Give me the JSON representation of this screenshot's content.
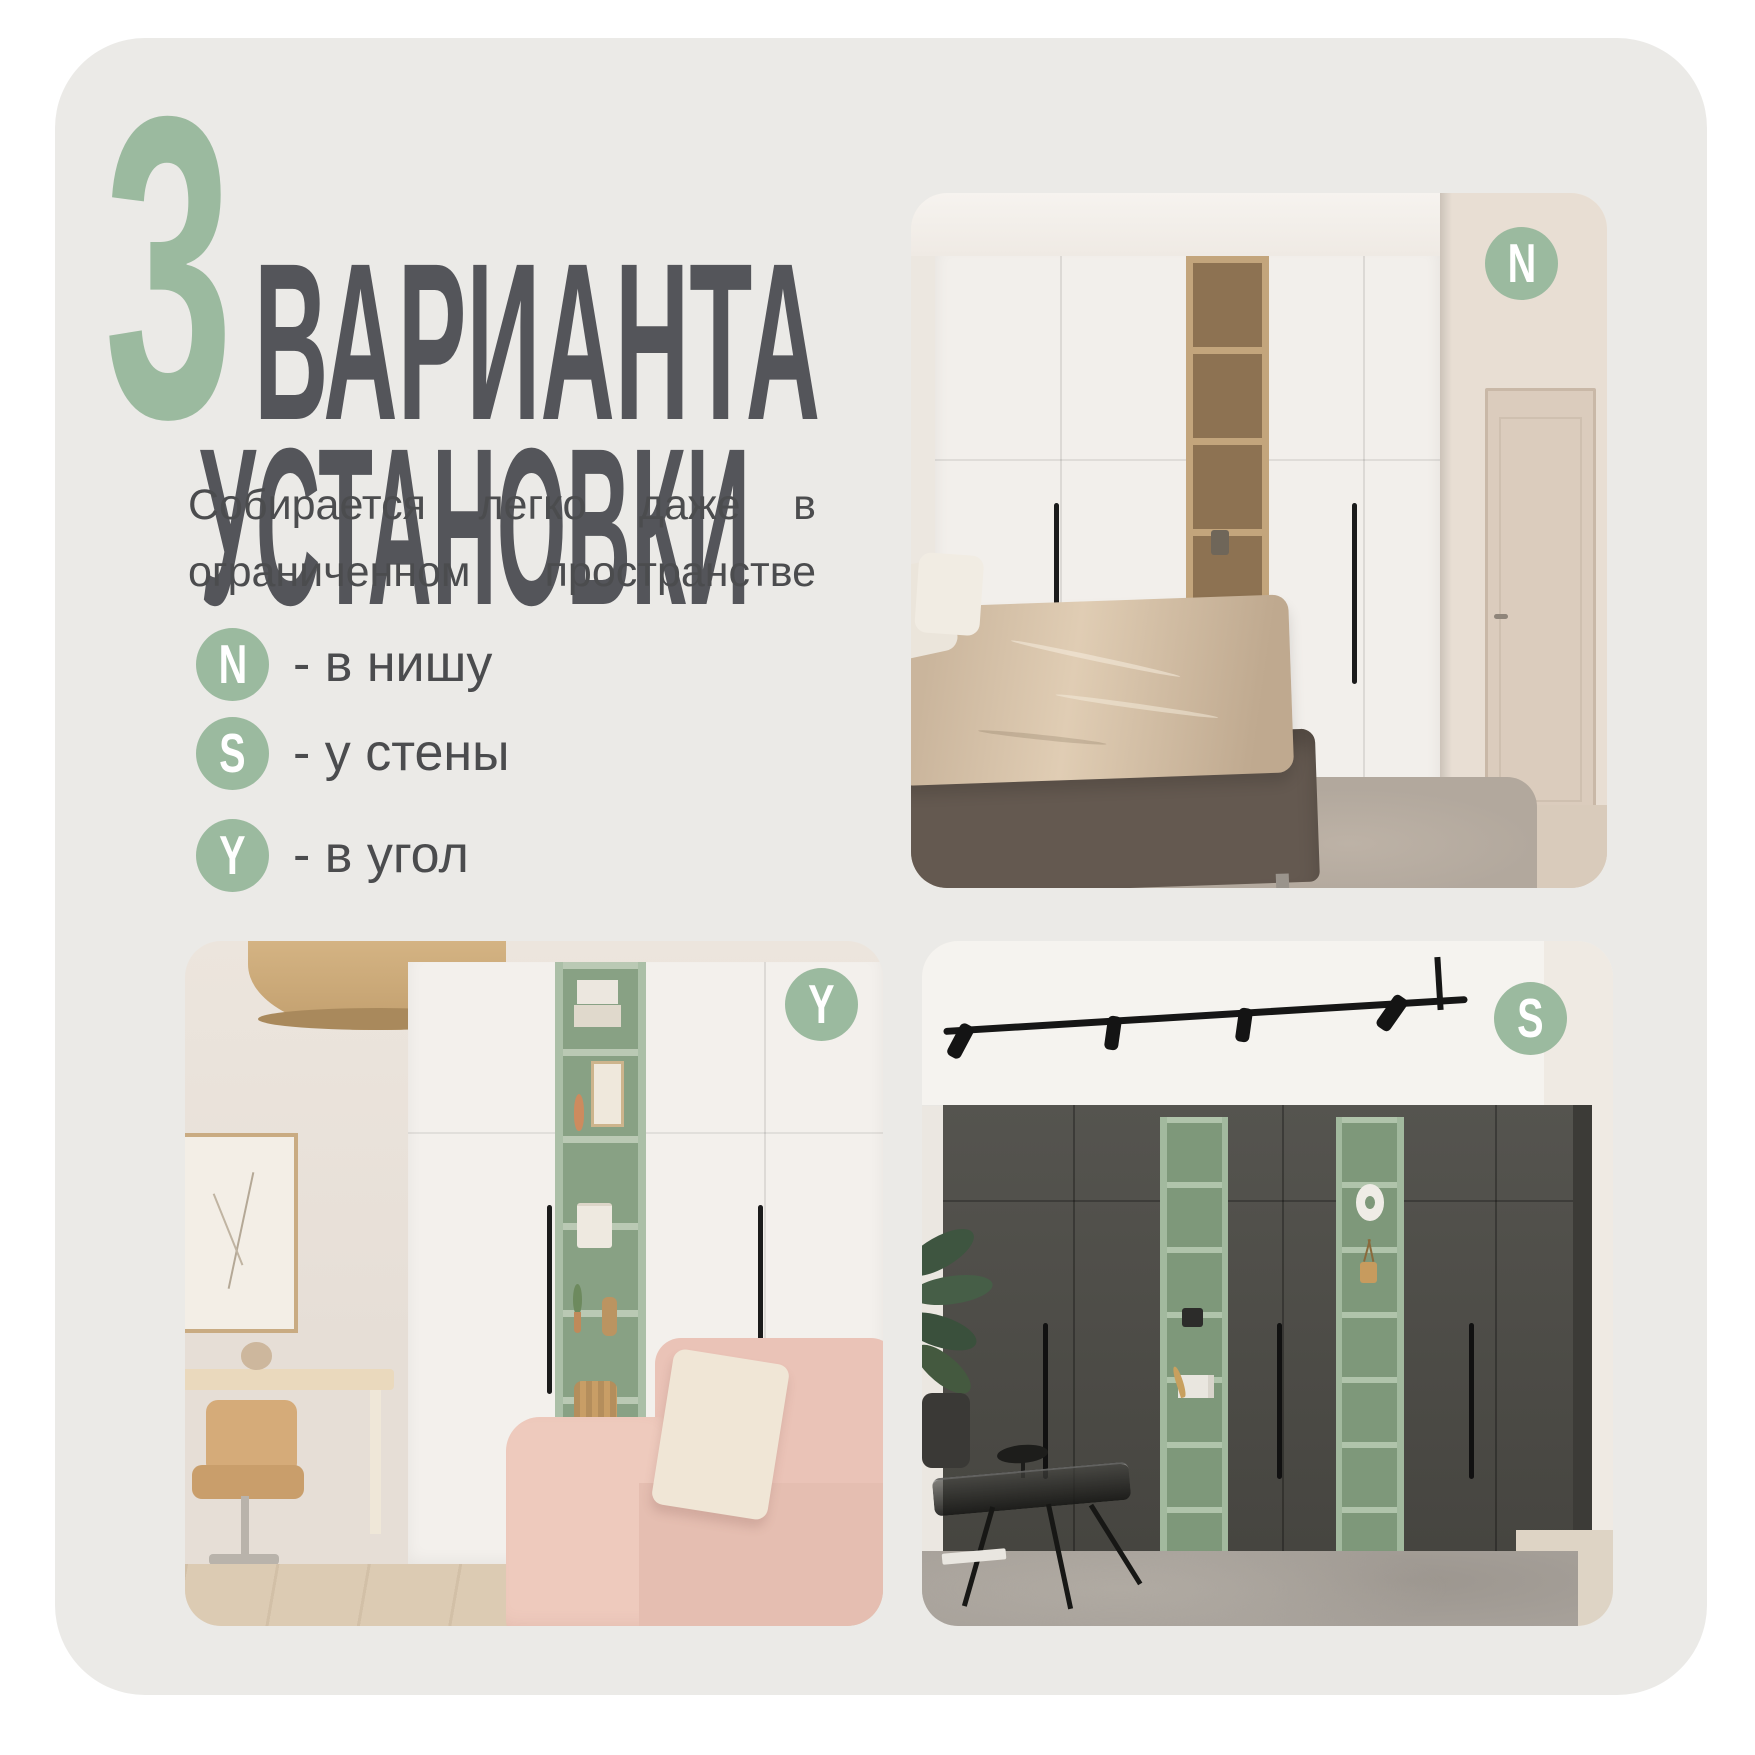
{
  "colors": {
    "accent_green": "#9BBA9F",
    "card_background": "#EBEAE7",
    "title_gray": "#54555A",
    "body_gray": "#4B4C4E"
  },
  "title": {
    "number": "3",
    "line1": "ВАРИАНТА",
    "line2": "УСТАНОВКИ"
  },
  "subtitle": {
    "full_text": "Собирается легко даже в ограниченном пространстве",
    "line1_words": [
      "Собирается",
      "легко",
      "даже",
      "в"
    ],
    "line2_words": [
      "ограниченном",
      "пространстве"
    ]
  },
  "legend": {
    "items": [
      {
        "letter": "N",
        "label": "- в нишу"
      },
      {
        "letter": "S",
        "label": "- у стены"
      },
      {
        "letter": "Y",
        "label": "- в угол"
      }
    ]
  },
  "photos": [
    {
      "id": "niche",
      "badge_letter": "N"
    },
    {
      "id": "corner",
      "badge_letter": "Y"
    },
    {
      "id": "wall",
      "badge_letter": "S"
    }
  ]
}
